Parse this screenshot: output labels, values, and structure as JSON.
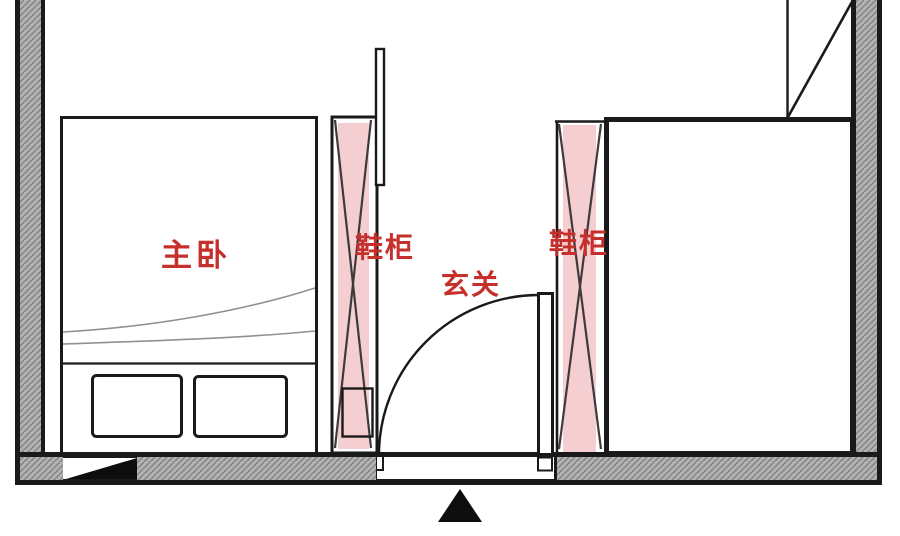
{
  "plan": {
    "kind": "floor-plan",
    "language": "zh-CN"
  },
  "labels": {
    "master_bedroom": "主卧",
    "shoe_cabinet_left": "鞋柜",
    "shoe_cabinet_right": "鞋柜",
    "entry": "玄关"
  },
  "icons": {
    "entrance_arrow": "entrance-direction-arrow",
    "wall_opening_marker": "black-triangle-wall-marker"
  },
  "colors": {
    "label_red": "#c5302c",
    "cabinet_pink": "#f5ced2",
    "wall_fill_gray": "#b2b2b2",
    "wall_hatch_gray": "#7d7d7d",
    "line_black": "#1a1a1a"
  }
}
